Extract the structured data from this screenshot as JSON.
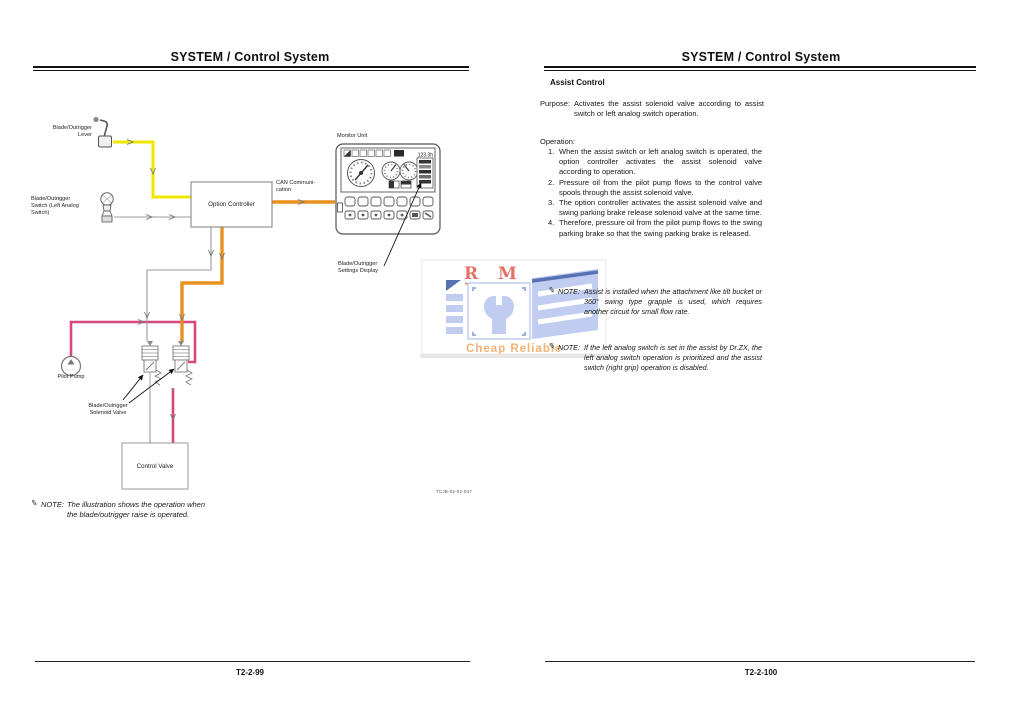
{
  "left_page": {
    "header": "SYSTEM / Control System",
    "footer": "T2-2-99",
    "note": {
      "label": "NOTE:",
      "text": "The illustration shows the operation when\nthe blade/outrigger raise is operated."
    },
    "diagram": {
      "labels": {
        "lever": "Blade/Outrigger\nLever",
        "switch": "Blade/Outrigger\nSwitch (Left Analog\nSwitch)",
        "option_controller": "Option Controller",
        "can": "CAN Communi-\ncation",
        "monitor_unit": "Monitor Unit",
        "settings_display": "Blade/Outrigger\nSettings Display",
        "pilot_pump": "Pilot Pump",
        "solenoid_valve": "Blade/Outrigger\nSolenoid Valve",
        "control_valve": "Control Valve",
        "drawing_code": "TCJB-02-02-047"
      },
      "monitor": {
        "hour_meter": "123.3h"
      },
      "colors": {
        "lever_wire": "#f0e600",
        "signal_wire": "#9b9b9b",
        "can_wire": "#e8911f",
        "pilot_wire": "#d6477e"
      }
    }
  },
  "right_page": {
    "header": "SYSTEM / Control System",
    "footer": "T2-2-100",
    "section_title": "Assist Control",
    "purpose": {
      "label": "Purpose:",
      "text": "Activates the assist solenoid valve according to assist switch or left analog switch operation."
    },
    "operation": {
      "label": "Operation:",
      "items": [
        {
          "num": "1.",
          "text": "When the assist switch or left analog switch is operated, the option controller activates the assist solenoid valve according to operation."
        },
        {
          "num": "2.",
          "text": "Pressure oil from the pilot pump flows to the control valve spools through the assist solenoid valve."
        },
        {
          "num": "3.",
          "text": "The option controller activates the assist solenoid valve and swing parking brake release solenoid valve at the same time."
        },
        {
          "num": "4.",
          "text": "Therefore, pressure oil from the pilot pump flows to the swing parking brake so that the swing parking brake is released."
        }
      ]
    },
    "notes": [
      {
        "label": "NOTE:",
        "text": "Assist is installed when the attachment like tilt bucket or 360° swing type grapple is used, which requires another circuit for small flow rate."
      },
      {
        "label": "NOTE:",
        "text": "If the left analog switch is set in the assist by Dr.ZX, the left analog switch operation is prioritized and the assist switch (right grip) operation is disabled."
      }
    ]
  },
  "watermark": {
    "letters": "R M",
    "tagline": "Cheap Reliable",
    "colors": {
      "letters": "#e2584b",
      "shape": "#b7c4ef",
      "tagline": "#f4a45f",
      "accent": "#3c59a8"
    }
  }
}
